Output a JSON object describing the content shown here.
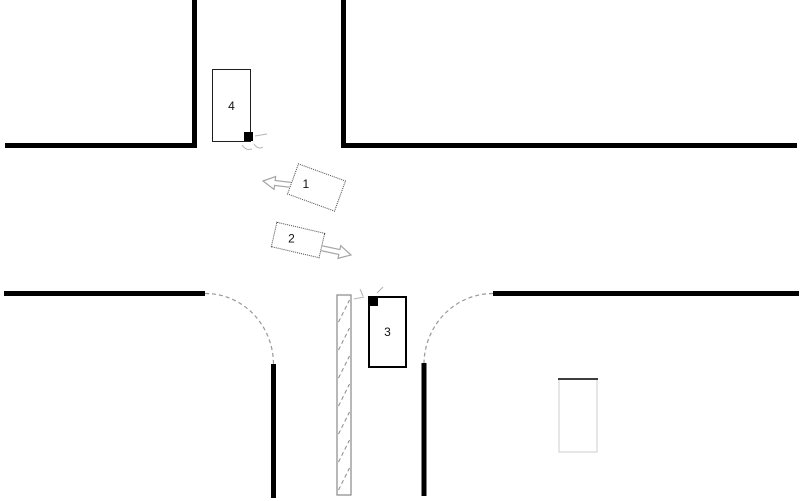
{
  "diagram": {
    "type": "traffic-collision-intersection-sketch",
    "vehicles": [
      {
        "label": "1"
      },
      {
        "label": "2"
      },
      {
        "label": "3"
      },
      {
        "label": "4"
      }
    ],
    "colors": {
      "background": "#ffffff",
      "road_edge": "#000000",
      "corner_curve": "#999999",
      "crosswalk_border": "#888888",
      "crosswalk_hatch": "#8a8a8a",
      "arrow_outline": "#a6a6a6",
      "impact_marker": "#000000",
      "scratch_marks": "#b5b5b5",
      "ghost_box_top": "#3d3d3d",
      "ghost_box_side": "#cccccc",
      "vehicle_border_solid": "#1f1f1f",
      "vehicle_border_dotted": "#4a4a4a"
    }
  }
}
